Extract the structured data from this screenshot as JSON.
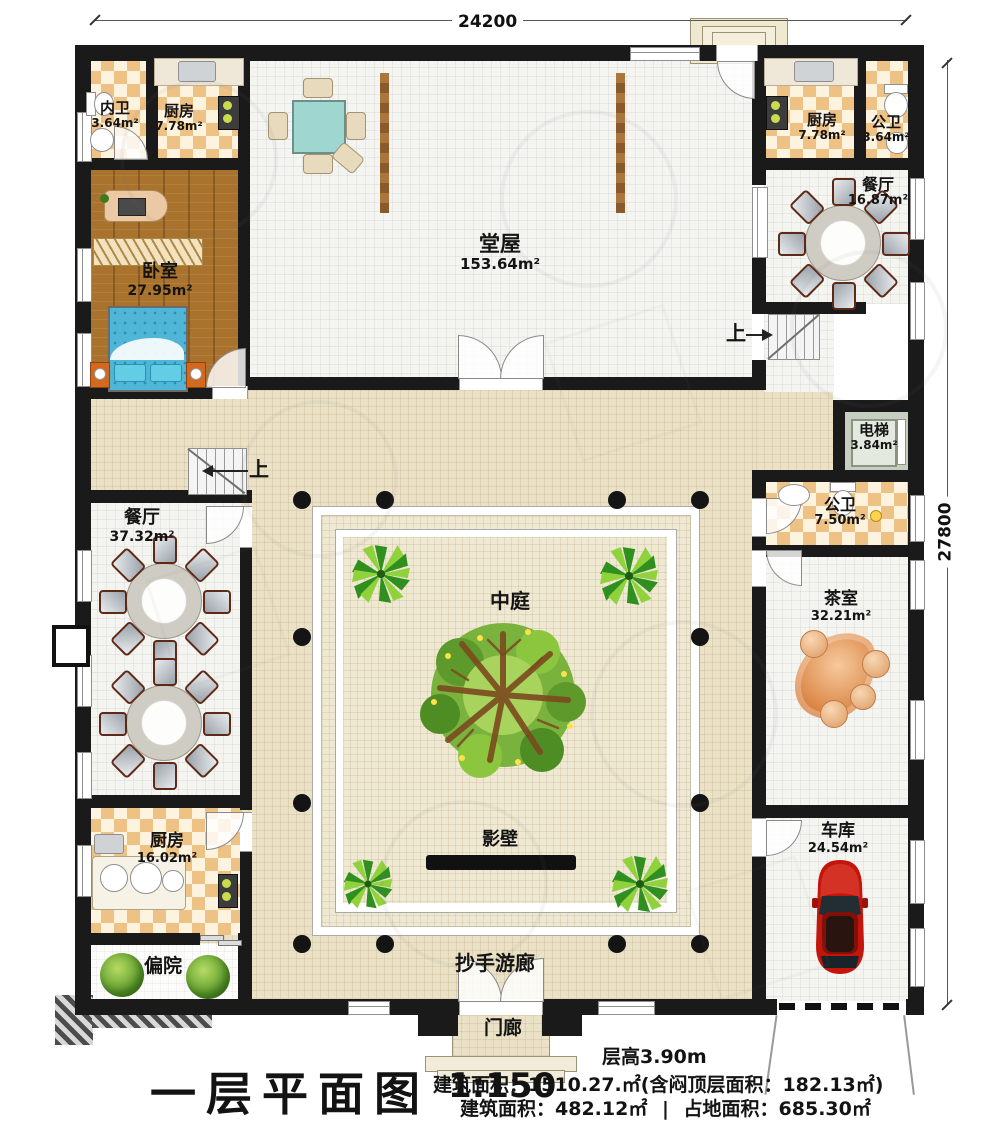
{
  "dimensions": {
    "top": "24200",
    "right": "27800"
  },
  "rooms": [
    {
      "name": "内卫",
      "area": "3.64m²"
    },
    {
      "name": "厨房",
      "area": "7.78m²"
    },
    {
      "name": "卧室",
      "area": "27.95m²"
    },
    {
      "name": "堂屋",
      "area": "153.64m²"
    },
    {
      "name": "厨房",
      "area": "7.78m²"
    },
    {
      "name": "公卫",
      "area": "3.64m²"
    },
    {
      "name": "餐厅",
      "area": "16.87m²"
    },
    {
      "name": "电梯",
      "area": "3.84m²"
    },
    {
      "name": "公卫",
      "area": "7.50m²"
    },
    {
      "name": "茶室",
      "area": "32.21m²"
    },
    {
      "name": "餐厅",
      "area": "37.32m²"
    },
    {
      "name": "厨房",
      "area": "16.02m²"
    },
    {
      "name": "偏院",
      "area": ""
    },
    {
      "name": "车库",
      "area": "24.54m²"
    },
    {
      "name": "中庭",
      "area": ""
    },
    {
      "name": "影壁",
      "area": ""
    },
    {
      "name": "抄手游廊",
      "area": ""
    },
    {
      "name": "门廊",
      "area": ""
    }
  ],
  "stairs": {
    "up_left": "上",
    "up_right": "上"
  },
  "title_block": {
    "plan_title": "一层平面图",
    "scale": "1:150",
    "floor_height": "层高3.90m",
    "area_line1": "建筑面积：1510.27.㎡(含闷顶层面积：182.13㎡)",
    "area_total": "建筑面积：482.12㎡",
    "divider": "|",
    "area_footprint": "占地面积：685.30㎡"
  }
}
